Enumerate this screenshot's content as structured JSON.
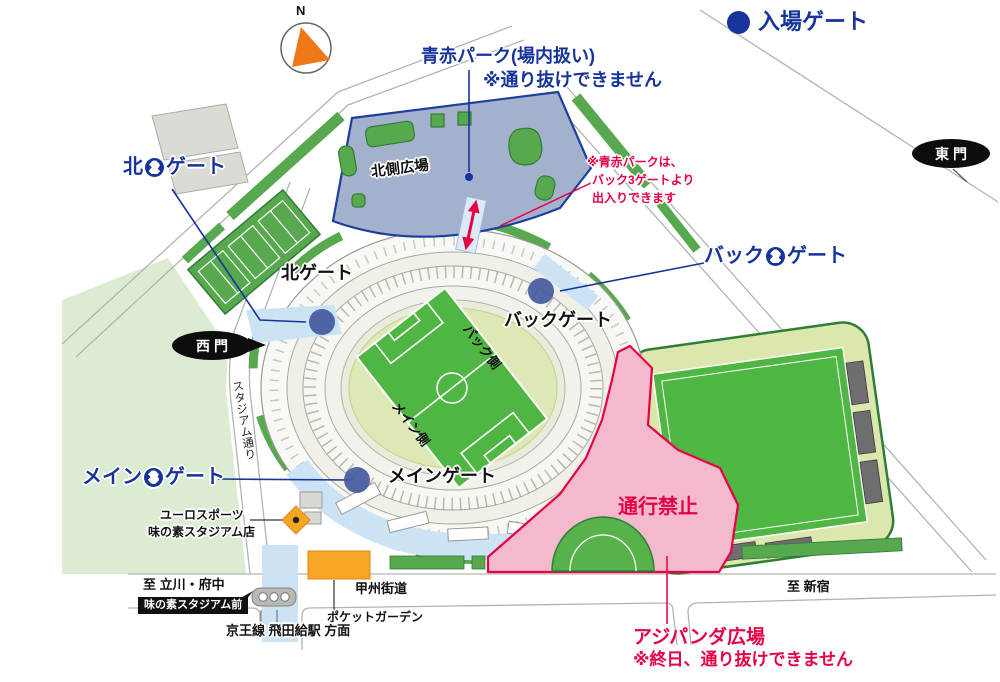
{
  "legend": {
    "label": "入場ゲート"
  },
  "compass": {
    "north": "N"
  },
  "park_note": {
    "line1": "青赤パーク(場内扱い)",
    "line2": "※通り抜けできません"
  },
  "access_note": {
    "line1": "※青赤パークは、",
    "line2": "バック3ゲートより",
    "line3": "出入りできます"
  },
  "gates": {
    "north2": {
      "prefix": "北",
      "number": "2",
      "suffix": "ゲート"
    },
    "back2": {
      "prefix": "バック",
      "number": "2",
      "suffix": "ゲート"
    },
    "main3": {
      "prefix": "メイン",
      "number": "3",
      "suffix": "ゲート"
    },
    "north": "北ゲート",
    "back": "バックゲート",
    "main": "メインゲート",
    "east": "東門",
    "west": "西門"
  },
  "areas": {
    "north_plaza": "北側広場",
    "back_side": "バック側",
    "main_side": "メイン側",
    "no_entry": "通行禁止",
    "ajipanda": {
      "line1": "アジパンダ広場",
      "line2": "※終日、通り抜けできません"
    }
  },
  "streets": {
    "stadium_street": "スタジアム通り",
    "koshu_kaido": "甲州街道",
    "to_tachikawa_fuchu": "至 立川・府中",
    "to_shinjuku": "至 新宿",
    "bus_stop": "味の素スタジアム前",
    "keio_line": "京王線 飛田給駅 方面",
    "pocket_garden": "ポケットガーデン"
  },
  "shops": {
    "line1": "ユーロスポーツ",
    "line2": "味の素スタジアム店"
  },
  "colors": {
    "gate_blue": "#16349b",
    "alert_red": "#e60044",
    "no_entry_pink": "#f4b9cc",
    "plaza_blue_gray": "#a4b1cd",
    "pitch_green": "#4fb543",
    "tree_green": "#57a84e",
    "walkway_blue": "#cbe3f5",
    "shop_orange": "#f6a623"
  }
}
